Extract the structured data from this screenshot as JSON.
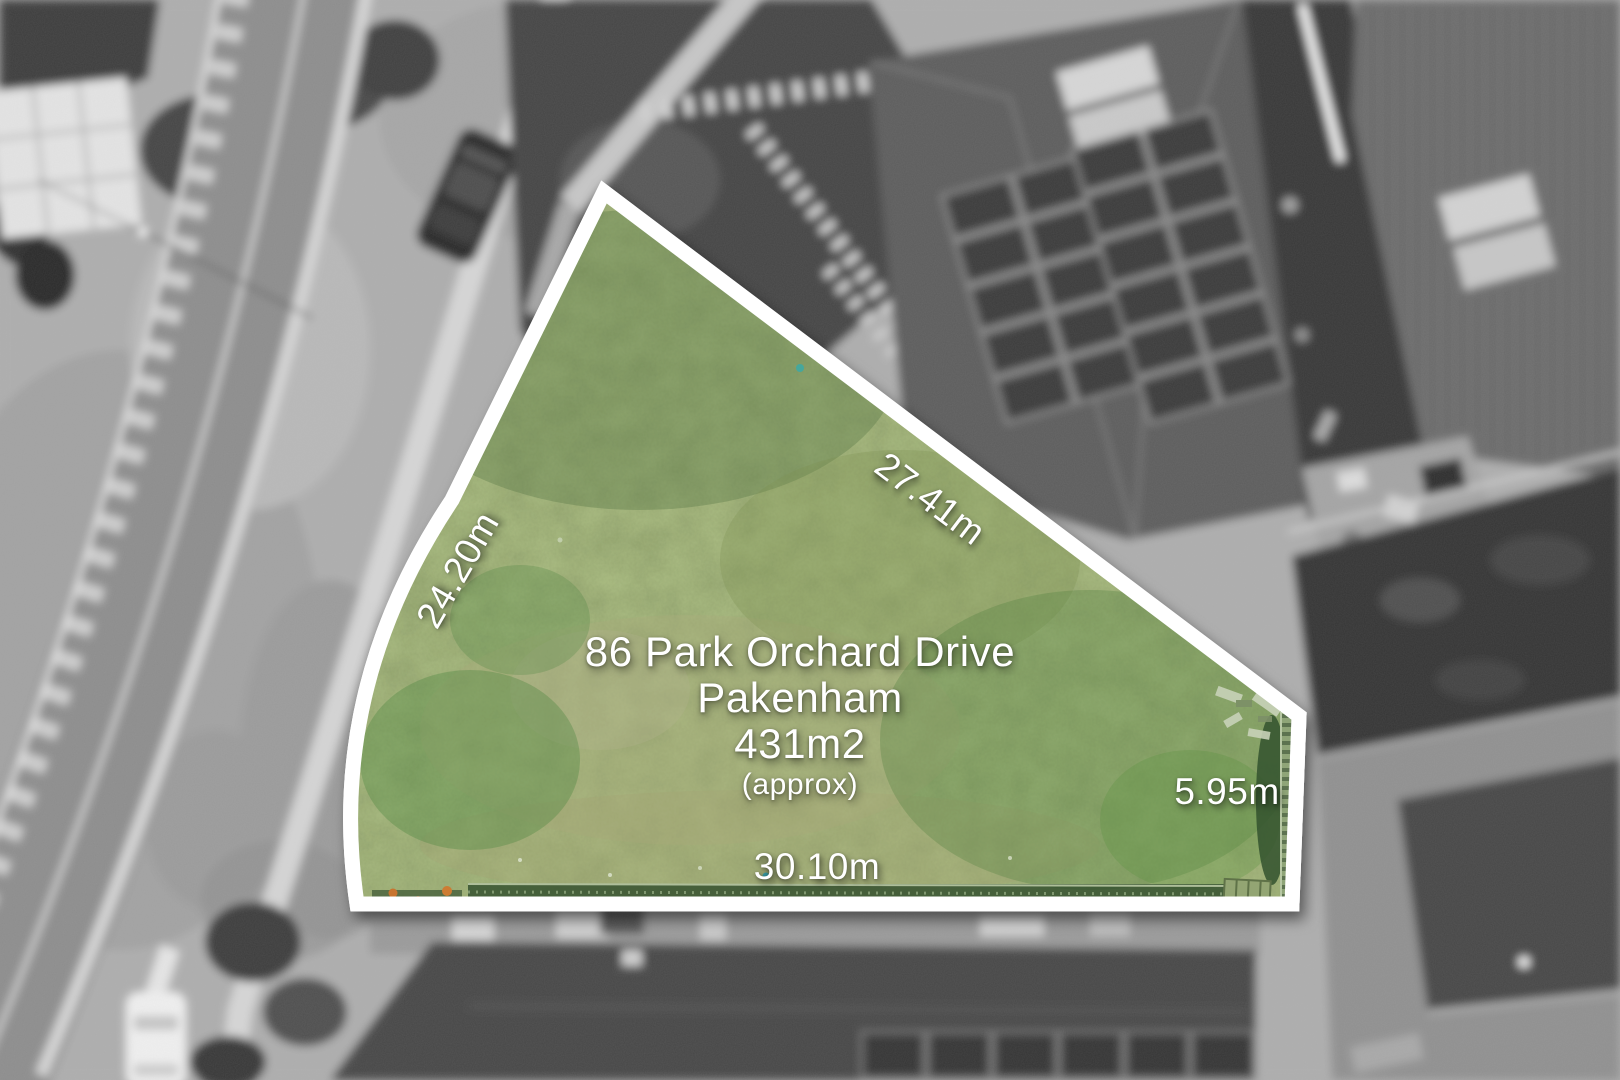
{
  "annotation": {
    "address_line1": "86 Park Orchard Drive",
    "address_line2": "Pakenham",
    "area": "431m2",
    "area_qualifier": "(approx)",
    "dimensions": [
      {
        "side": "left",
        "label": "24.20m"
      },
      {
        "side": "top-right",
        "label": "27.41m"
      },
      {
        "side": "right",
        "label": "5.95m"
      },
      {
        "side": "bottom",
        "label": "30.10m"
      }
    ]
  },
  "colors": {
    "boundary_white": "#ffffff",
    "lot_green_base": "#75894f",
    "label_text": "#ffffff"
  }
}
